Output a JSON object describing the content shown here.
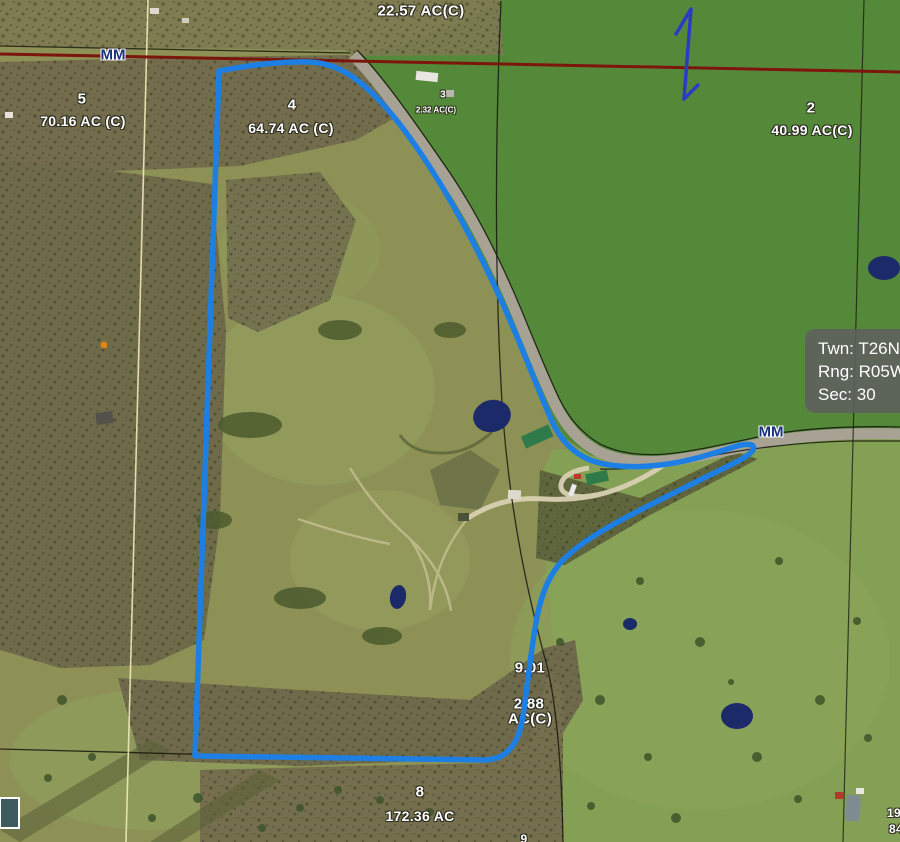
{
  "map_view": {
    "highway_label_top": "MM",
    "highway_label_right": "MM",
    "labels": {
      "top_parcel_acreage": "22.57 AC(C)",
      "mid_partial_number": "9.01",
      "small_parcel_acreage_line1": "2.88",
      "small_parcel_acreage_line2": "AC(C)",
      "bottom_edge_partial": "9",
      "right_edge_partial_top": "19.",
      "right_edge_partial_bottom": "84"
    },
    "parcels": [
      {
        "number": "5",
        "acreage": "70.16 AC (C)"
      },
      {
        "number": "4",
        "acreage": "64.74 AC (C)"
      },
      {
        "number": "3",
        "acreage": "2.32 AC(C)"
      },
      {
        "number": "2",
        "acreage": "40.99 AC(C)"
      },
      {
        "number": "8",
        "acreage": "172.36 AC"
      }
    ],
    "info_box": {
      "township": "Twn: T26N",
      "range": "Rng: R05W",
      "section": "Sec: 30"
    },
    "colors": {
      "selected_boundary": "#1d7fe3",
      "highway_line": "#7c150c",
      "north_arrow": "#2b3cc4",
      "info_box_bg": "rgba(95,95,95,0.88)",
      "road_label_text": "#18307f",
      "pond": "#1c2a6a"
    }
  }
}
